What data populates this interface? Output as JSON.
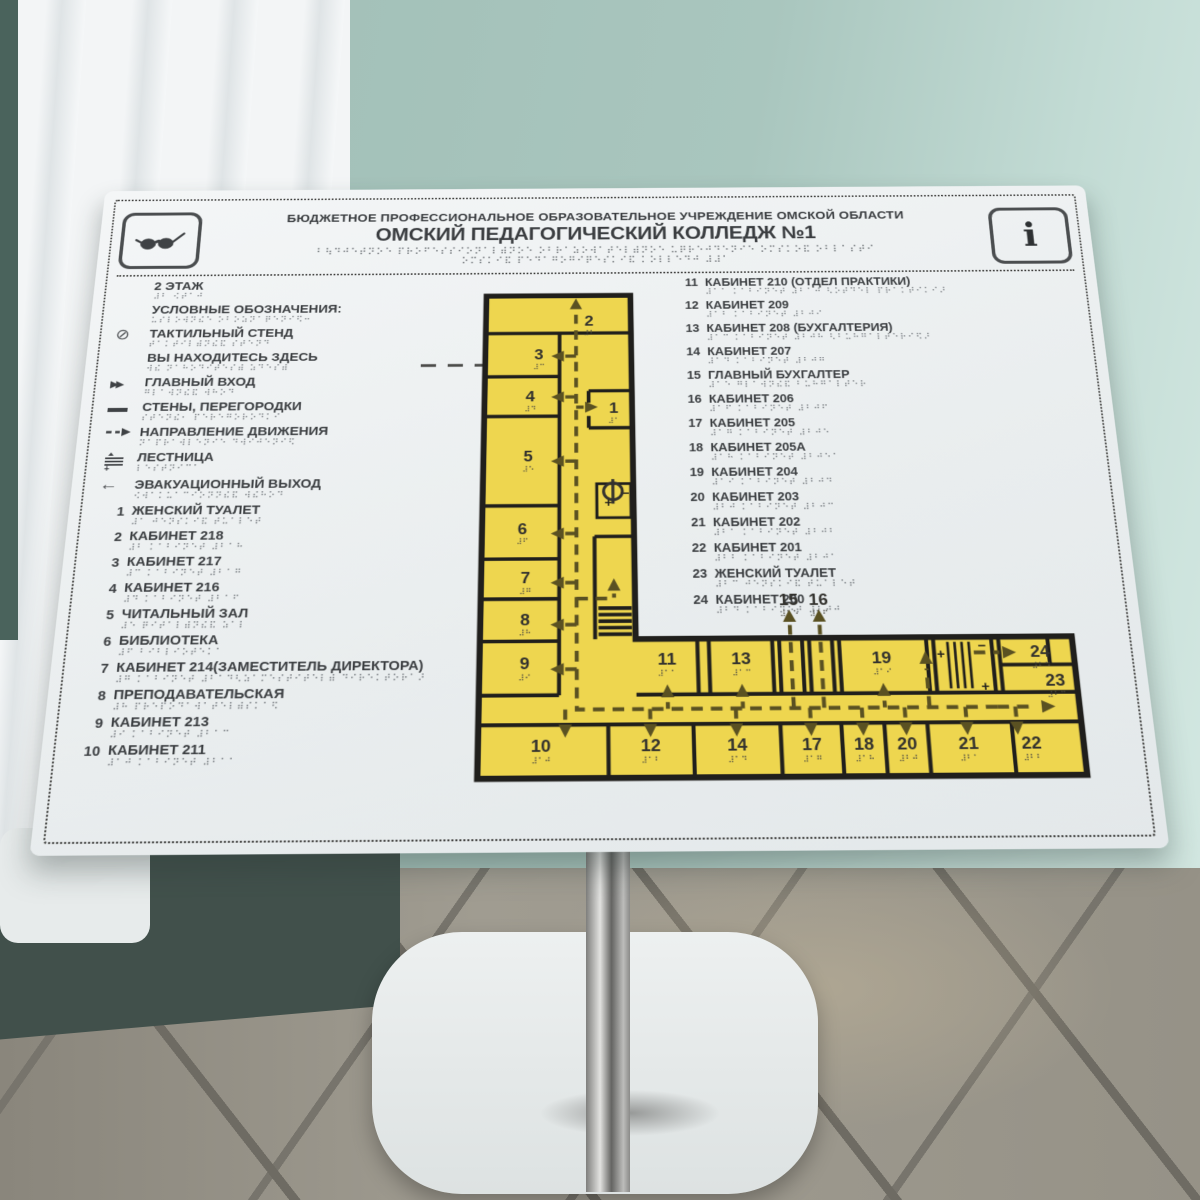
{
  "header": {
    "org_line": "БЮДЖЕТНОЕ ПРОФЕССИОНАЛЬНОЕ ОБРАЗОВАТЕЛЬНОЕ УЧРЕЖДЕНИЕ ОМСКОЙ ОБЛАСТИ",
    "title": "ОМСКИЙ ПЕДАГОГИЧЕСКИЙ КОЛЛЕДЖ №1",
    "left_icon": "glasses-icon",
    "right_icon": "info-icon"
  },
  "legend": {
    "floor": "2 ЭТАЖ",
    "heading": "УСЛОВНЫЕ ОБОЗНАЧЕНИЯ:",
    "items": [
      {
        "icon": "tactile-stand-icon",
        "label": "ТАКТИЛЬНЫЙ СТЕНД"
      },
      {
        "icon": "you-are-here-line",
        "label": "ВЫ НАХОДИТЕСЬ ЗДЕСЬ"
      },
      {
        "icon": "main-entrance-icon",
        "label": "ГЛАВНЫЙ ВХОД"
      },
      {
        "icon": "walls-icon",
        "label": "СТЕНЫ, ПЕРЕГОРОДКИ"
      },
      {
        "icon": "direction-icon",
        "label": "НАПРАВЛЕНИЕ ДВИЖЕНИЯ"
      },
      {
        "icon": "stairs-icon",
        "label": "ЛЕСТНИЦА"
      },
      {
        "icon": "exit-icon",
        "label": "ЭВАКУАЦИОННЫЙ ВЫХОД"
      }
    ]
  },
  "rooms_left": [
    {
      "num": "1",
      "label": "ЖЕНСКИЙ ТУАЛЕТ"
    },
    {
      "num": "2",
      "label": "КАБИНЕТ 218"
    },
    {
      "num": "3",
      "label": "КАБИНЕТ 217"
    },
    {
      "num": "4",
      "label": "КАБИНЕТ 216"
    },
    {
      "num": "5",
      "label": "ЧИТАЛЬНЫЙ ЗАЛ"
    },
    {
      "num": "6",
      "label": "БИБЛИОТЕКА"
    },
    {
      "num": "7",
      "label": "КАБИНЕТ 214(ЗАМЕСТИТЕЛЬ ДИРЕКТОРА)"
    },
    {
      "num": "8",
      "label": "ПРЕПОДАВАТЕЛЬСКАЯ"
    },
    {
      "num": "9",
      "label": "КАБИНЕТ 213"
    },
    {
      "num": "10",
      "label": "КАБИНЕТ 211"
    }
  ],
  "rooms_right": [
    {
      "num": "11",
      "label": "КАБИНЕТ 210 (ОТДЕЛ ПРАКТИКИ)"
    },
    {
      "num": "12",
      "label": "КАБИНЕТ 209"
    },
    {
      "num": "13",
      "label": "КАБИНЕТ 208 (БУХГАЛТЕРИЯ)"
    },
    {
      "num": "14",
      "label": "КАБИНЕТ 207"
    },
    {
      "num": "15",
      "label": "ГЛАВНЫЙ БУХГАЛТЕР"
    },
    {
      "num": "16",
      "label": "КАБИНЕТ 206"
    },
    {
      "num": "17",
      "label": "КАБИНЕТ 205"
    },
    {
      "num": "18",
      "label": "КАБИНЕТ 205А"
    },
    {
      "num": "19",
      "label": "КАБИНЕТ 204"
    },
    {
      "num": "20",
      "label": "КАБИНЕТ 203"
    },
    {
      "num": "21",
      "label": "КАБИНЕТ 202"
    },
    {
      "num": "22",
      "label": "КАБИНЕТ 201"
    },
    {
      "num": "23",
      "label": "ЖЕНСКИЙ ТУАЛЕТ"
    },
    {
      "num": "24",
      "label": "КАБИНЕТ 200"
    }
  ],
  "plan": {
    "floor_label": "2 ЭТАЖ",
    "room_numbers": [
      "1",
      "2",
      "3",
      "4",
      "5",
      "6",
      "7",
      "8",
      "9",
      "10",
      "11",
      "12",
      "13",
      "14",
      "15",
      "16",
      "17",
      "18",
      "19",
      "20",
      "21",
      "22",
      "23",
      "24"
    ],
    "colors": {
      "room_fill": "#eed64f",
      "wall_line": "#201f1c",
      "path_line": "#5a5122",
      "board": "#f0f2f3",
      "wall_paint": "#a9c6be",
      "text": "#3b3e41"
    }
  }
}
